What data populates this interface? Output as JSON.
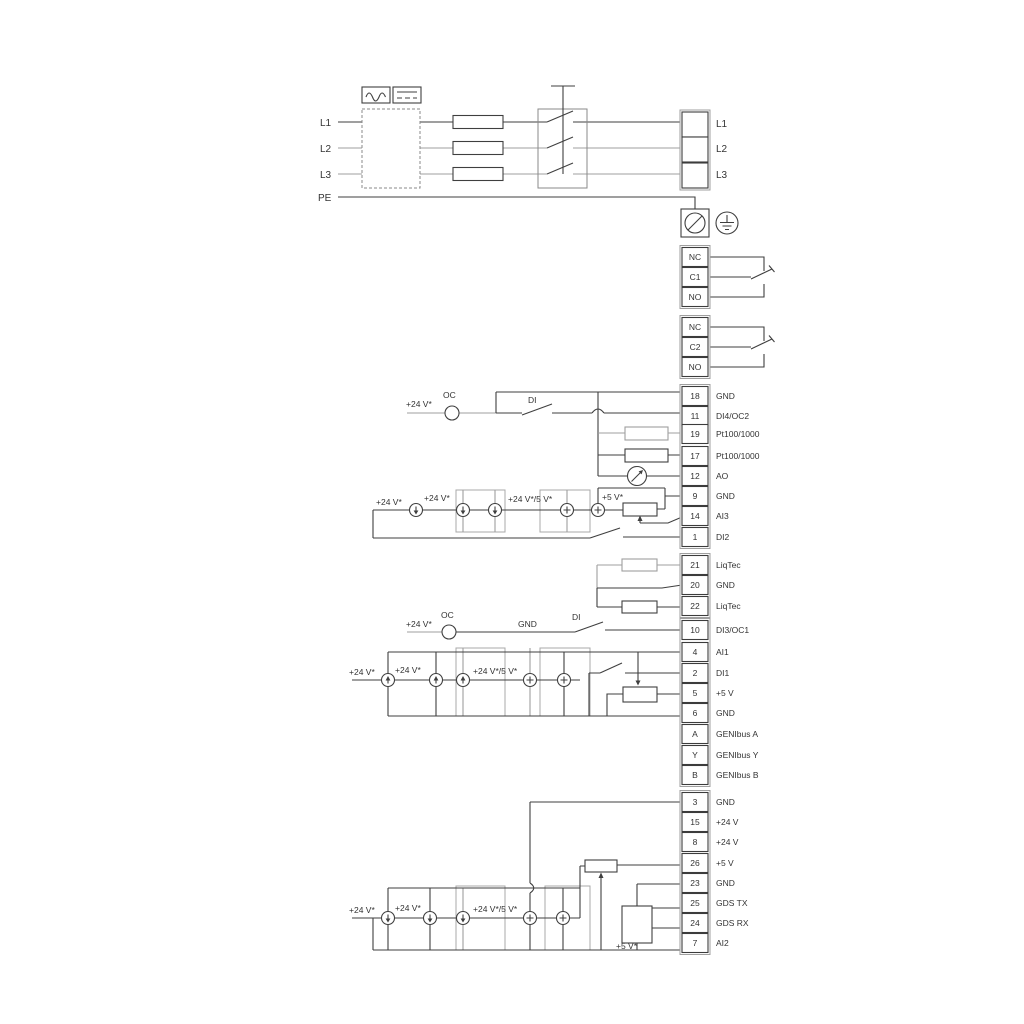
{
  "diagram_type": "wiring-diagram",
  "colors": {
    "wire": "#3f3f3f",
    "wire_alt": "#9f9f9f",
    "text": "#333333",
    "background": "#ffffff"
  },
  "power": {
    "inputs": [
      {
        "label": "L1"
      },
      {
        "label": "L2"
      },
      {
        "label": "L3"
      },
      {
        "label": "PE"
      }
    ],
    "icons": {
      "ac": "ac-wave-icon",
      "dc": "dc-line-icon",
      "fuse": "fuse-icon",
      "main_switch": "main-switch-icon",
      "screw_terminal": "screw-terminal-icon",
      "earth": "protective-earth-icon"
    }
  },
  "terminals": {
    "power_out": [
      {
        "label": "L1"
      },
      {
        "label": "L2"
      },
      {
        "label": "L3"
      }
    ],
    "relay1": [
      {
        "id": "NC"
      },
      {
        "id": "C1"
      },
      {
        "id": "NO"
      }
    ],
    "relay2": [
      {
        "id": "NC"
      },
      {
        "id": "C2"
      },
      {
        "id": "NO"
      }
    ],
    "io_a": [
      {
        "no": "18",
        "label": "GND"
      },
      {
        "no": "11",
        "label": "DI4/OC2"
      },
      {
        "no": "19",
        "label": "Pt100/1000"
      },
      {
        "no": "17",
        "label": "Pt100/1000"
      },
      {
        "no": "12",
        "label": "AO"
      },
      {
        "no": "9",
        "label": "GND"
      },
      {
        "no": "14",
        "label": "AI3"
      },
      {
        "no": "1",
        "label": "DI2"
      }
    ],
    "liqtec": [
      {
        "no": "21",
        "label": "LiqTec"
      },
      {
        "no": "20",
        "label": "GND"
      },
      {
        "no": "22",
        "label": "LiqTec"
      }
    ],
    "io_b": [
      {
        "no": "10",
        "label": "DI3/OC1"
      },
      {
        "no": "4",
        "label": "AI1"
      },
      {
        "no": "2",
        "label": "DI1"
      },
      {
        "no": "5",
        "label": "+5 V"
      },
      {
        "no": "6",
        "label": "GND"
      },
      {
        "no": "A",
        "label": "GENIbus A"
      },
      {
        "no": "Y",
        "label": "GENIbus Y"
      },
      {
        "no": "B",
        "label": "GENIbus B"
      }
    ],
    "io_c": [
      {
        "no": "3",
        "label": "GND"
      },
      {
        "no": "15",
        "label": "+24 V"
      },
      {
        "no": "8",
        "label": "+24 V"
      },
      {
        "no": "26",
        "label": "+5 V"
      },
      {
        "no": "23",
        "label": "GND"
      },
      {
        "no": "25",
        "label": "GDS TX"
      },
      {
        "no": "24",
        "label": "GDS RX"
      },
      {
        "no": "7",
        "label": "AI2"
      }
    ]
  },
  "annotations": {
    "oc2_supply": "+24 V*",
    "oc2": "OC",
    "di4": "DI",
    "ai3_s1": "+24 V*",
    "ai3_s2": "+24 V*",
    "ai3_s3": "+24 V*/5 V*",
    "ai3_s4": "+5 V*",
    "oc1_supply": "+24 V*",
    "oc1": "OC",
    "oc1_gnd": "GND",
    "di3": "DI",
    "ai1_s1": "+24 V*",
    "ai1_s2": "+24 V*",
    "ai1_s3": "+24 V*/5 V*",
    "ai2_s1": "+24 V*",
    "ai2_s2": "+24 V*",
    "ai2_s3": "+24 V*/5 V*",
    "ai2_s4": "+5 V*"
  }
}
